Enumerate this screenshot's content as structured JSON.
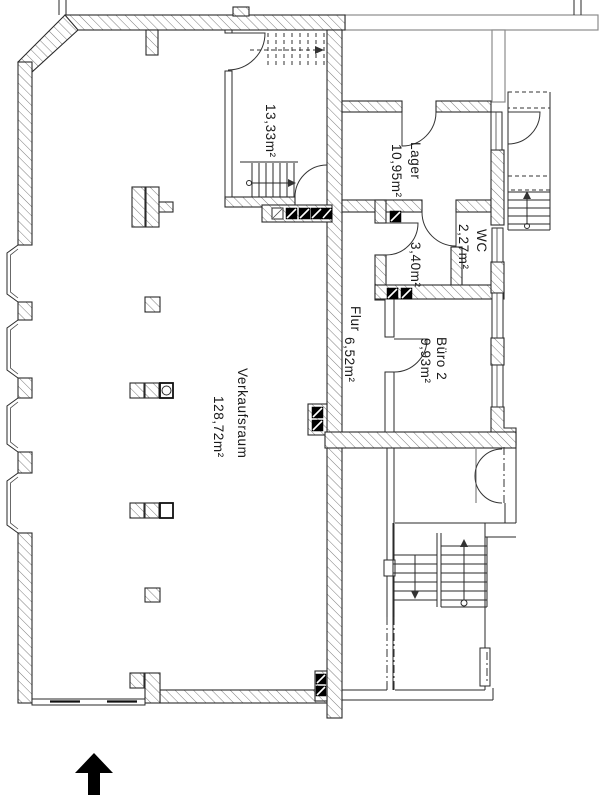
{
  "drawing_type": "architectural-floor-plan",
  "rooms": {
    "verkaufsraum": {
      "name": "Verkaufsraum",
      "area": "128,72m²"
    },
    "treppenraum": {
      "name": "",
      "area": "13,33m²"
    },
    "lager": {
      "name": "Lager",
      "area": "10,95m²"
    },
    "wc": {
      "name": "WC",
      "area": "2,27m²"
    },
    "vorraum": {
      "name": "",
      "area": "3,40m²"
    },
    "flur": {
      "name": "Flur",
      "area": "6,52m²"
    },
    "buero_2": {
      "name": "Büro 2",
      "area": "9,93m²"
    }
  },
  "compass": {
    "type": "north-arrow",
    "direction": "up"
  },
  "colors": {
    "background": "#ffffff",
    "wall_line": "#2a2a2a",
    "hatch": "#6e6e6e",
    "neighbor_outline": "#8c8c8c",
    "column": "#000000"
  }
}
